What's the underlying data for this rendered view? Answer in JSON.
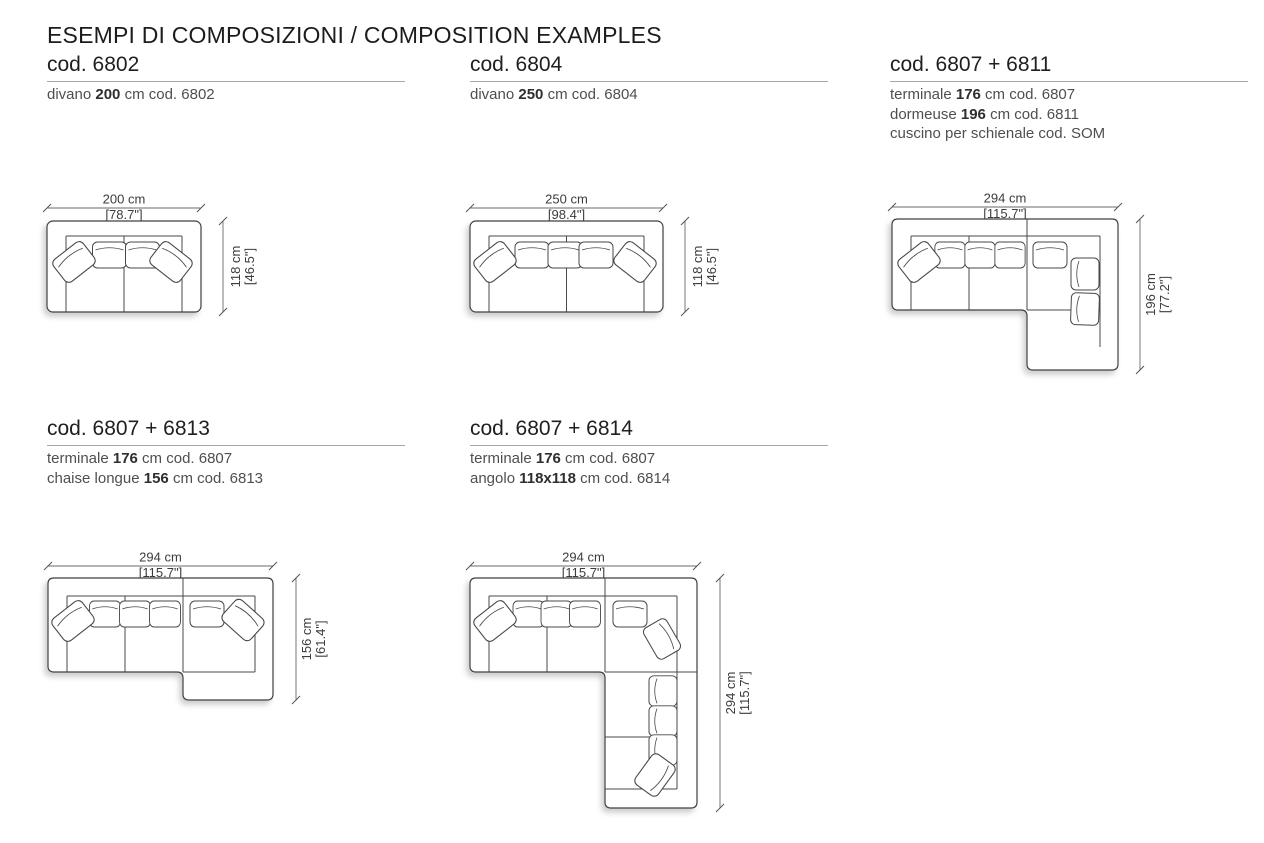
{
  "page": {
    "title": "ESEMPI DI COMPOSIZIONI / COMPOSITION EXAMPLES"
  },
  "compositions": [
    {
      "code": "cod. 6802",
      "lines": [
        {
          "pre": "divano ",
          "value": "200",
          "post": " cm cod. 6802"
        }
      ],
      "dim": {
        "w": "200 cm",
        "w_in": "[78.7\"]",
        "d": "118 cm",
        "d_in": "[46.5\"]"
      }
    },
    {
      "code": "cod. 6804",
      "lines": [
        {
          "pre": "divano ",
          "value": "250",
          "post": " cm cod. 6804"
        }
      ],
      "dim": {
        "w": "250 cm",
        "w_in": "[98.4\"]",
        "d": "118 cm",
        "d_in": "[46.5\"]"
      }
    },
    {
      "code": "cod. 6807 + 6811",
      "lines": [
        {
          "pre": "terminale ",
          "value": "176",
          "post": " cm cod. 6807"
        },
        {
          "pre": "dormeuse ",
          "value": "196",
          "post": " cm cod. 6811"
        },
        {
          "pre": "cuscino per schienale cod. SOM",
          "value": "",
          "post": ""
        }
      ],
      "dim": {
        "w": "294 cm",
        "w_in": "[115.7\"]",
        "d": "196 cm",
        "d_in": "[77.2\"]"
      }
    },
    {
      "code": "cod. 6807 + 6813",
      "lines": [
        {
          "pre": "terminale ",
          "value": "176",
          "post": " cm cod. 6807"
        },
        {
          "pre": "chaise longue ",
          "value": "156",
          "post": " cm cod. 6813"
        }
      ],
      "dim": {
        "w": "294 cm",
        "w_in": "[115.7\"]",
        "d": "156 cm",
        "d_in": "[61.4\"]"
      }
    },
    {
      "code": "cod. 6807 + 6814",
      "lines": [
        {
          "pre": "terminale ",
          "value": "176",
          "post": " cm cod. 6807"
        },
        {
          "pre": "angolo ",
          "value": "118x118",
          "post": " cm cod. 6814"
        }
      ],
      "dim": {
        "w": "294 cm",
        "w_in": "[115.7\"]",
        "d": "294 cm",
        "d_in": "[115.7\"]"
      }
    }
  ]
}
